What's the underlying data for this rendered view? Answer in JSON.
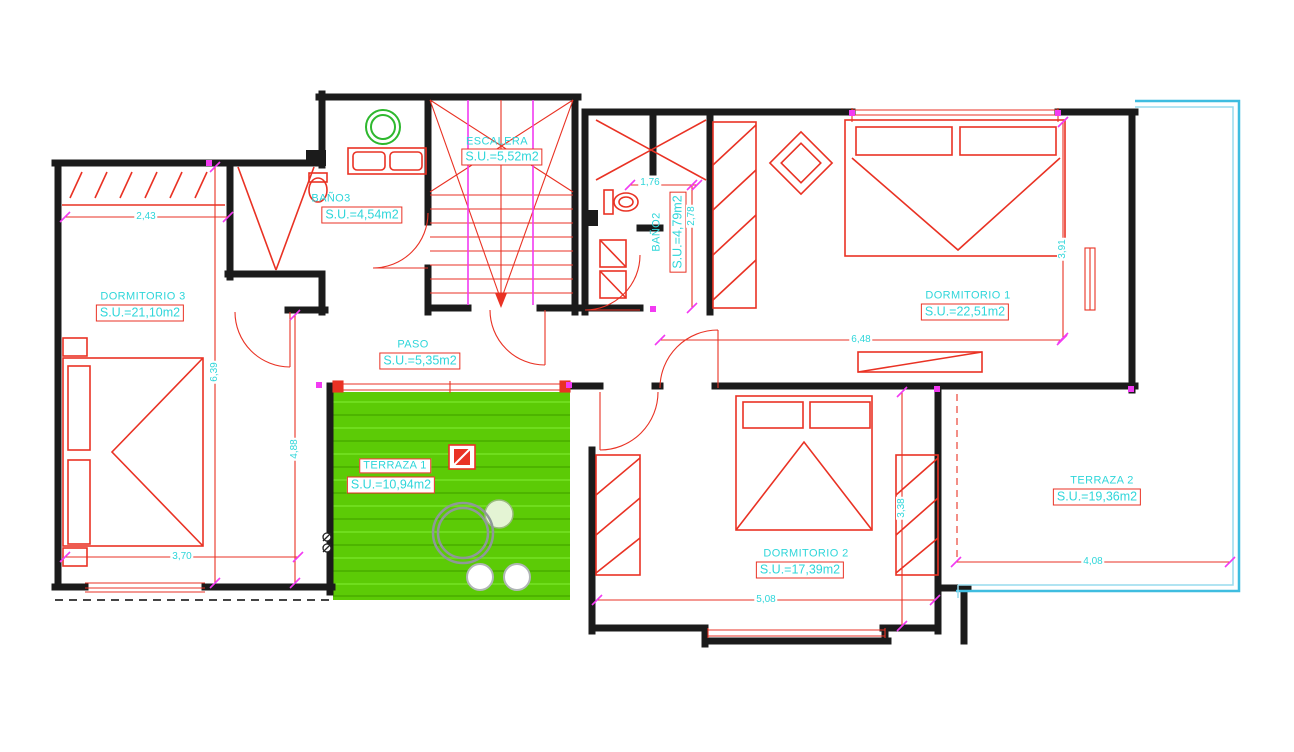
{
  "drawing": {
    "kind": "floor-plan",
    "units": "m2",
    "colors": {
      "walls": "#1b1b1b",
      "furniture_lines": "#e93224",
      "label_text": "#2fd6da",
      "terrace_fill": "#5ccb06",
      "accent_magenta": "#f23bf2",
      "terrace2_outline": "#3fbde0"
    }
  },
  "rooms": [
    {
      "id": "dormitorio-3",
      "name": "DORMITORIO 3",
      "area": "S.U.=21,10m2"
    },
    {
      "id": "bano-3",
      "name": "BAÑO3",
      "area": "S.U.=4,54m2"
    },
    {
      "id": "escalera",
      "name": "ESCALERA",
      "area": "S.U.=5,52m2"
    },
    {
      "id": "bano-2",
      "name": "BAÑO2",
      "area": "S.U.=4,79m2"
    },
    {
      "id": "dormitorio-1",
      "name": "DORMITORIO 1",
      "area": "S.U.=22,51m2"
    },
    {
      "id": "paso",
      "name": "PASO",
      "area": "S.U.=5,35m2"
    },
    {
      "id": "terraza-1",
      "name": "TERRAZA 1",
      "area": "S.U.=10,94m2"
    },
    {
      "id": "dormitorio-2",
      "name": "DORMITORIO 2",
      "area": "S.U.=17,39m2"
    },
    {
      "id": "terraza-2",
      "name": "TERRAZA 2",
      "area": "S.U.=19,36m2"
    }
  ],
  "dims": [
    {
      "value": "2,43"
    },
    {
      "value": "1,76"
    },
    {
      "value": "6,48"
    },
    {
      "value": "3,70"
    },
    {
      "value": "5,08"
    },
    {
      "value": "4,08"
    },
    {
      "value": "6,39"
    },
    {
      "value": "4,88"
    },
    {
      "value": "2,78"
    },
    {
      "value": "3,91"
    },
    {
      "value": "3,38"
    }
  ]
}
